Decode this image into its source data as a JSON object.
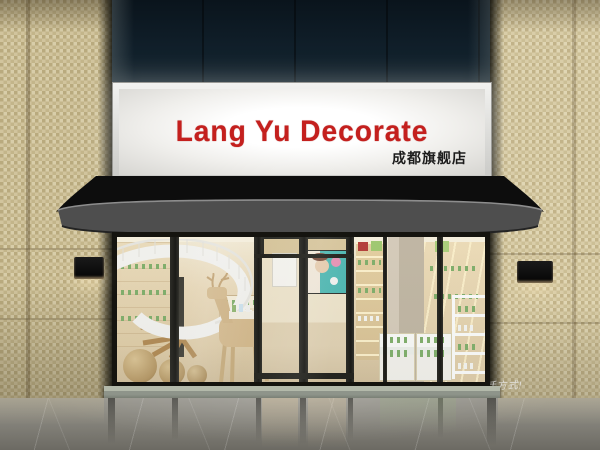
{
  "sign": {
    "main": "Lang Yu Decorate",
    "sub": "成都旗舰店",
    "main_color": "#c4201e",
    "sub_color": "#1c1c1c",
    "panel_color": "#f5f4f1"
  },
  "awning": {
    "slogan": "simple!另一种生活方式!",
    "slogan_color": "#e9e9e9",
    "canopy_color": "#0d0d0d",
    "fascia_color": "#4e4e4e"
  },
  "palette": {
    "facade_dark": "#101f2a",
    "tile_beige": "#d1c49d",
    "interior_warm": "#ead9b8",
    "wood": "#d8c094",
    "product_green": "#7fae68",
    "frame_dark": "#15140f",
    "floor_gray": "#85837b",
    "step_stone": "#8e948a"
  }
}
